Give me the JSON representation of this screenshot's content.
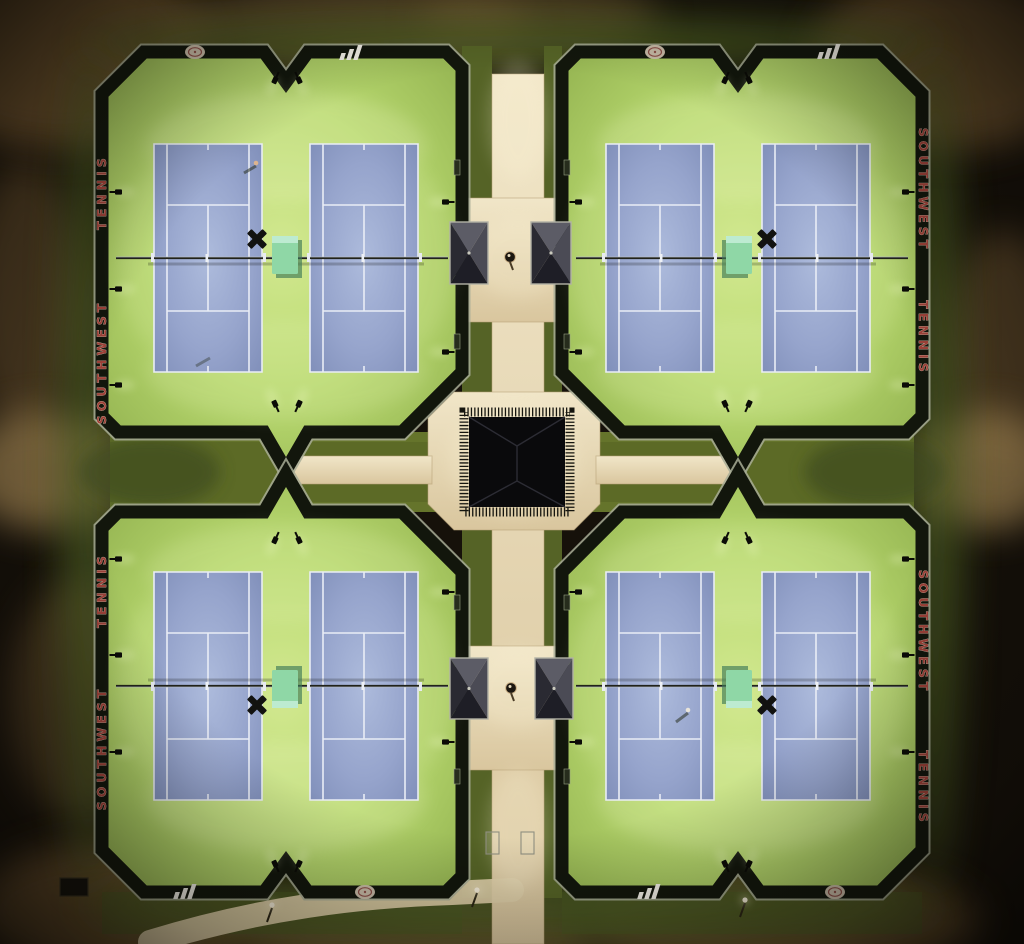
{
  "scene": {
    "description": "Night aerial photograph of a lighted tennis complex with four fenced quadrants around a central pavilion",
    "quadrant_count": 4,
    "courts_per_quadrant": 2,
    "total_courts": 8
  },
  "banners": {
    "west_upper": {
      "upper": "TENNIS",
      "lower": "SOUTHWEST"
    },
    "west_lower": {
      "upper": "TENNIS",
      "lower": "SOUTHWEST"
    },
    "east_upper": {
      "upper": "SOUTHWEST",
      "lower": "TENNIS"
    },
    "east_lower": {
      "upper": "SOUTHWEST",
      "lower": "TENNIS"
    }
  },
  "icons": [
    "three-stripes-logo",
    "club-crest-logo",
    "fan-x-icon",
    "floodlight-icon",
    "gazebo-roof",
    "pavilion-roof",
    "drinking-fountain"
  ],
  "colors": {
    "background": "#16110a",
    "brown_patch_1": "#6e532e",
    "brown_patch_2": "#8a6b3c",
    "dirt_tan": "#9c8050",
    "grass_lit": "#4a5a22",
    "corridor_grass": "#5c6a26",
    "apron_bright": "#d2e890",
    "apron_green": "#b9da70",
    "apron_dark": "#8cab4a",
    "court_blue": "#96a4cc",
    "court_blue_light": "#adbbdc",
    "court_line_white": "#e9edf6",
    "fence_dark": "#12160c",
    "fence_rail": "#a8ad96",
    "walkway_cream": "#e8d8b4",
    "walkway_shadow": "#b49f74",
    "pavilion_roof": "#0a0a0c",
    "gazebo_frame": "#b2b2a6",
    "bench_mint": "#8fd7a6",
    "bench_mint_shadow": "#3e7a58",
    "fan_black": "#121210",
    "banner_red": "#a6453c",
    "banner_outline": "#efe6d2",
    "logo_white": "#f2efe6",
    "crest_tan": "#d3c4b0",
    "net_dark": "#20221a"
  }
}
